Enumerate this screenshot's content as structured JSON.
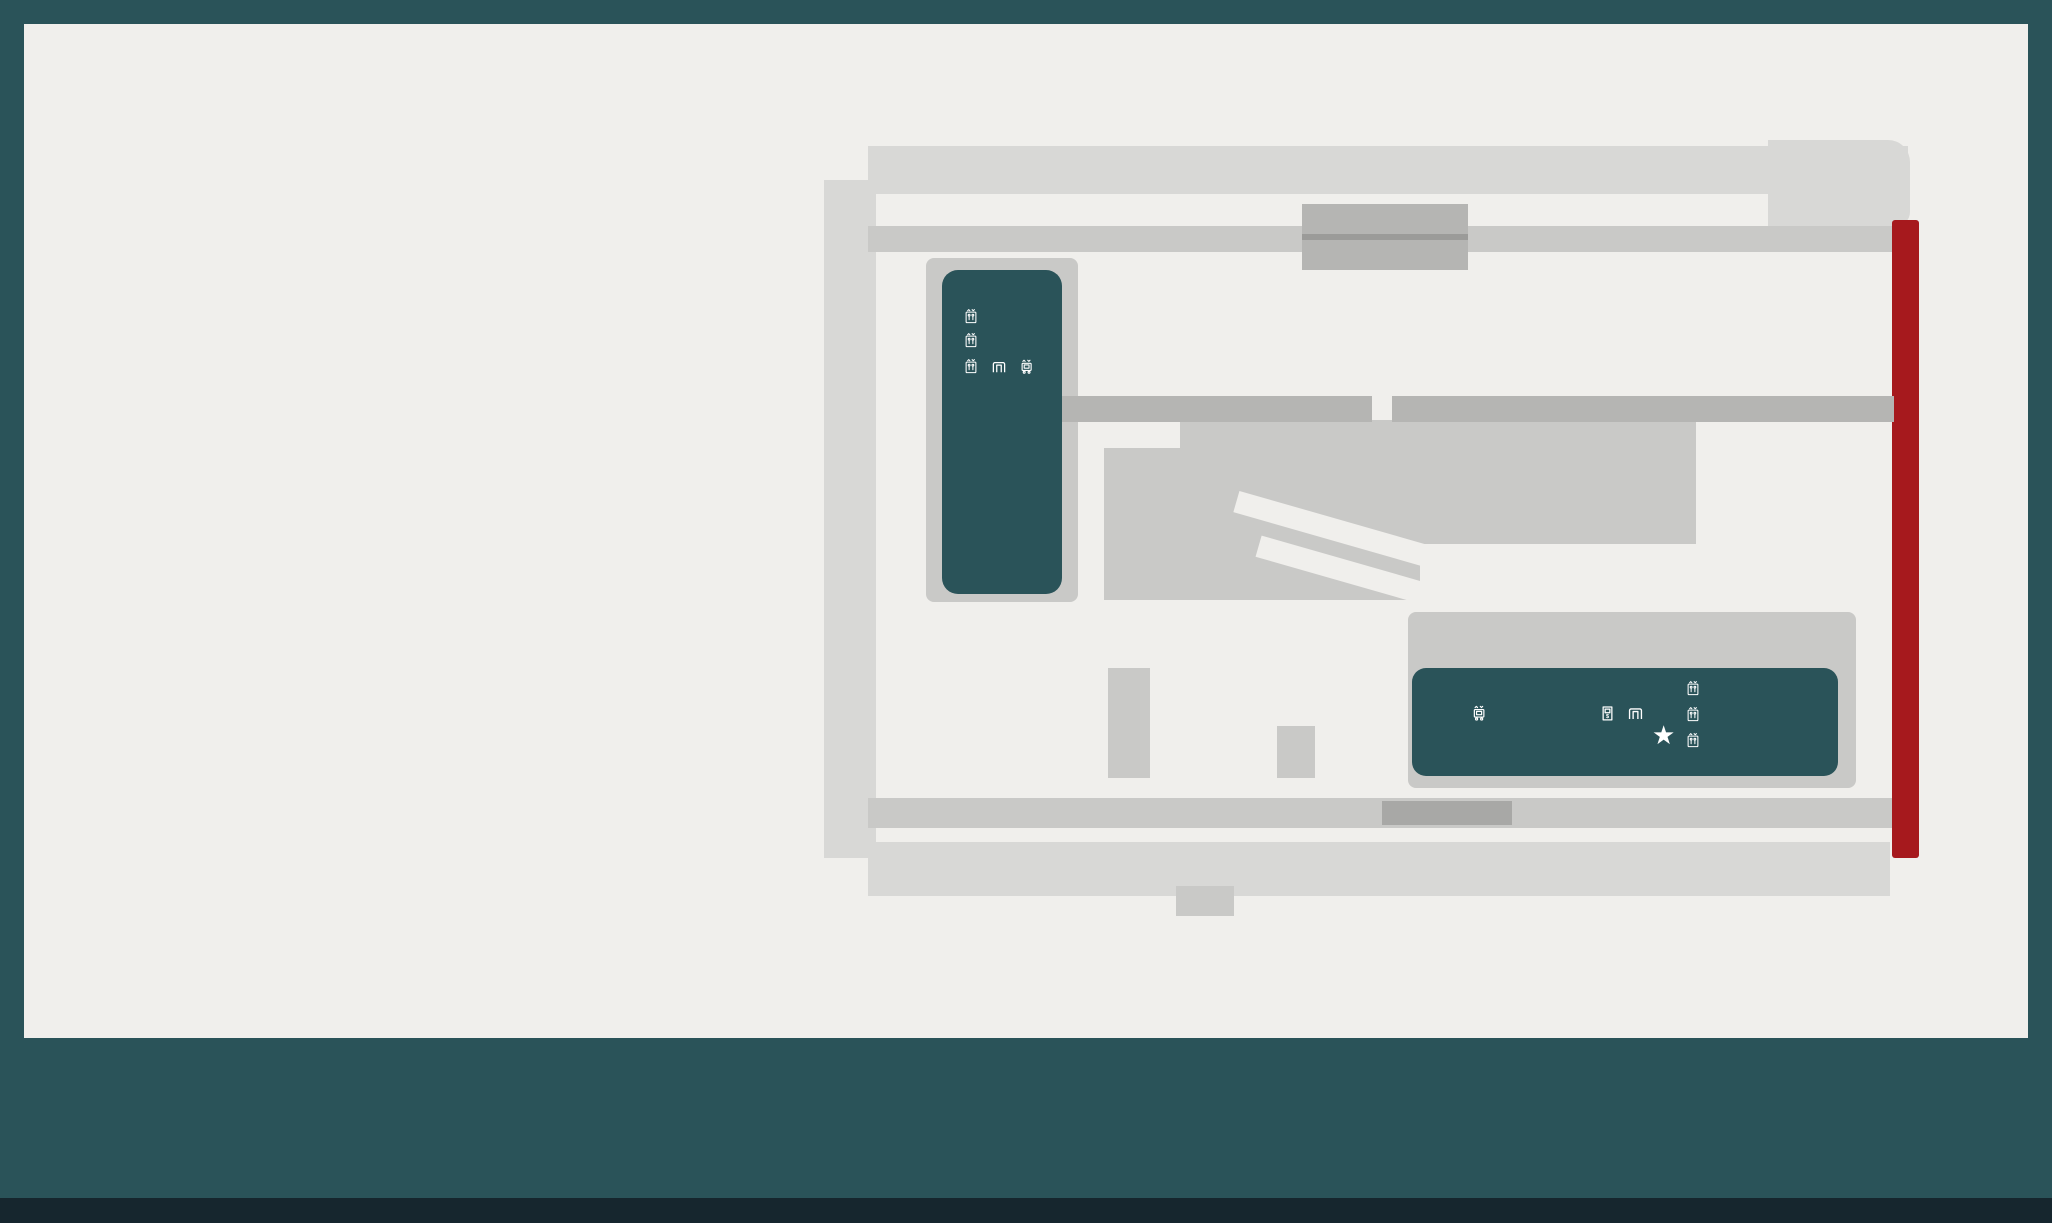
{
  "footer": {
    "level": "P4",
    "logo_letters": [
      "O",
      "X",
      "F",
      "O",
      "R",
      "D"
    ],
    "logo_bar_heights": [
      54,
      84,
      66,
      100,
      76
    ],
    "locations": [
      {
        "name": "Centennial Place East",
        "lines": [
          "520 3 Avenue South West,",
          "Calgary, Alberta T2P 0R3",
          "Lot 52"
        ],
        "x": 1428
      },
      {
        "name": "Centennial Place West",
        "lines": [
          "250 5th Street South West,",
          "Calgary, Alberta T2P 0R4",
          "Lot 52"
        ],
        "x": 1724
      }
    ]
  },
  "legend": {
    "left": [
      {
        "icon": "parking",
        "ring": "#223f46",
        "title": "Parking",
        "sub": ""
      },
      {
        "icon": "wheelchair",
        "ring": "#1b75bb",
        "title": "Barrier Free Parking",
        "sub": "Permit required"
      },
      {
        "icon": "carpool",
        "ring": "#7cab3c",
        "title": "Carpool Parking",
        "sub": "Permit required"
      },
      {
        "icon": "car",
        "ring": "#e2b322",
        "title": "Small Car Parking",
        "sub": ""
      },
      {
        "icon": "moto",
        "ring": "#b12025",
        "title": "Motorcycle Parking",
        "sub": "With or without a monthly parking pass"
      },
      {
        "icon": "battery",
        "ring": "#2b8a3d",
        "title": "Electric Vehicle Charging",
        "sub": ""
      },
      {
        "icon": "gate",
        "ring": "#e2b322",
        "title": "Entrance / Exit Gate",
        "sub": ""
      },
      {
        "icon": "wash",
        "ring": "#2c5f67",
        "title": "Window Wash",
        "sub": "Stations"
      },
      {
        "icon": "air",
        "ring": "#2c5f67",
        "title": "Air / Washer Fluid",
        "sub": "Stations"
      },
      {
        "icon": "recycle",
        "ring": "#2c5f67",
        "title": "Recycling",
        "sub": "Cans/bottles/cardboard and paper"
      },
      {
        "icon": "stairs",
        "ring": "#df8528",
        "title": "Stairwell Access",
        "sub": ""
      }
    ],
    "right": [
      {
        "icon": "lock",
        "ring": "split",
        "title": "Locker Rooms",
        "sub": ""
      },
      {
        "icon": "wc",
        "ring": "split",
        "title": "Washrooms",
        "sub": "Not for public use"
      },
      {
        "icon": "shower",
        "ring": "split",
        "title": "Showers",
        "sub": ""
      },
      {
        "icon": "carwash",
        "ring": "split",
        "title": "Car Wash",
        "sub": "Open to the public"
      },
      {
        "icon": "paystation",
        "ring": "#1f4f57",
        "title": "QR Pay Stations",
        "sub": "For public parking"
      },
      {
        "icon": "lobby",
        "ring": "#2c5f67",
        "title": "Elevator Lobby",
        "sub": ""
      },
      {
        "icon": "elevator",
        "ring": "#2c5f67",
        "title": "Elevator Access",
        "sub": "+15, Ground, P1 - P4"
      },
      {
        "icon": "freight",
        "ring": "#2c5f67",
        "title": "Freight Elevator",
        "sub": "P3 - Floor 24"
      },
      {
        "icon": "freight",
        "ring": "#2c5f67",
        "title": "Freight Elevator",
        "sub": "P3 - Floor 41"
      },
      {
        "icon": "clock",
        "ring": "#8248a8",
        "title": "Short stay parking",
        "sub": "4 hrs max (day care)."
      },
      {
        "icon": "star",
        "ring": "#2c5f67",
        "title": "You are here",
        "sub": ""
      }
    ]
  },
  "map": {
    "labels": {
      "avenue": "2ND AVENUE SW",
      "street_left": "5TH STREET SW",
      "street_right": "4TH STREET SW",
      "down_p5": "DOWN TO P5",
      "up_p3": "UP TO P3",
      "arr_r": "»»",
      "arr_l": "««",
      "traffic_arrow": "«",
      "traffic": "TRAFFIC FLOW",
      "entrance1": "PARKING ENTRANCE 5AM- 9AM",
      "entrance2": "REVERTS TO AN EXIT AT 9 AM, NO PUBLIC"
    },
    "blocks": {
      "west": "WEST",
      "east": "EAST"
    },
    "rows": [
      {
        "x": 877,
        "y": 156,
        "pitch": 28.6,
        "h": 34,
        "nums": [
          "688",
          "689",
          "690",
          "691",
          "692",
          "693",
          "694",
          "695",
          "696",
          "697",
          "698",
          "699",
          "700",
          "701",
          "493",
          "494",
          "495",
          "496",
          "497",
          "498",
          "499",
          "500",
          "501",
          "502",
          "503",
          "504",
          "505",
          "506",
          "507",
          "508",
          "509",
          "510"
        ]
      },
      {
        "x": 830,
        "y": 216,
        "pitch": 29.6,
        "w": 42,
        "vert": true,
        "nums": [
          "687",
          "686",
          "685",
          "684",
          "683",
          "682",
          "681",
          "680",
          "679",
          "678",
          "677",
          "676",
          "675",
          "674",
          "673",
          "672",
          "671",
          "670",
          "669",
          "668",
          "667"
        ]
      },
      {
        "x": 1062,
        "y": 291,
        "pitch": 29.3,
        "h": 43,
        "nums": [
          "721",
          "722",
          "723",
          "724",
          "725",
          "726",
          "727",
          "728",
          "521",
          "522",
          "523",
          "524",
          "525",
          "526",
          "527",
          "528",
          "529",
          "530",
          "531",
          "532",
          "533",
          "534",
          "535",
          "536",
          "537"
        ]
      },
      {
        "x": 1062,
        "y": 337,
        "pitch": 29.3,
        "h": 43,
        "nums": [
          "770",
          "769",
          "768",
          "767",
          "766",
          "765",
          "764",
          "763",
          "554",
          "553",
          "552",
          "551",
          "550",
          "549",
          "548",
          "547",
          "546",
          "545",
          "544",
          "543",
          "542",
          "541",
          "540",
          "539",
          "538"
        ]
      },
      {
        "x": 1185,
        "y": 428,
        "pitch": 23,
        "h": 38,
        "nums": [
          "774",
          "775",
          "776",
          "777",
          "570",
          "571",
          "572",
          "573",
          "574",
          "575",
          "576",
          "577",
          "578",
          "579",
          "580",
          "581",
          "582",
          "583",
          "584"
        ]
      },
      {
        "x": 1637,
        "y": 428,
        "pitch": 24.5,
        "h": 38,
        "nums": [
          "585",
          "586"
        ]
      },
      {
        "x": 1337,
        "y": 490,
        "pitch": 23.5,
        "h": 44,
        "nums": [
          "600",
          "599",
          "598",
          "597",
          "596",
          "595",
          "594",
          "593",
          "592",
          "591",
          "590",
          "589"
        ]
      },
      {
        "x": 1637,
        "y": 490,
        "pitch": 24.5,
        "h": 44,
        "nums": [
          "588",
          "587"
        ]
      },
      {
        "x": 945,
        "y": 668,
        "pitch": 26.3,
        "h": 52,
        "nums": [
          "604",
          "605",
          "606",
          "607",
          "608",
          "609"
        ]
      },
      {
        "x": 945,
        "y": 726,
        "pitch": 26.3,
        "h": 52,
        "nums": [
          "633",
          "632",
          "631",
          "630",
          "629",
          "628"
        ]
      },
      {
        "x": 1158,
        "y": 668,
        "pitch": 28.7,
        "h": 52,
        "nums": [
          "610",
          "611",
          "612",
          "613"
        ]
      },
      {
        "x": 1158,
        "y": 726,
        "pitch": 28.7,
        "h": 52,
        "nums": [
          "627",
          "626",
          "625",
          "624"
        ]
      },
      {
        "x": 1320,
        "y": 668,
        "pitch": 26,
        "h": 52,
        "nums": [
          "615",
          "616",
          "617"
        ]
      },
      {
        "x": 1320,
        "y": 726,
        "pitch": 26,
        "h": 52,
        "nums": [
          "623",
          "622",
          "621"
        ]
      },
      {
        "x": 877,
        "y": 852,
        "pitch": 29.4,
        "h": 34,
        "nums": [
          "666",
          "665",
          "664",
          "663",
          "662",
          "661",
          "660",
          "659",
          "658",
          "657",
          "656",
          "655",
          "654",
          "653",
          "652",
          "651",
          "650",
          "649",
          "648",
          "647",
          "646",
          "645",
          "644",
          "643",
          "642",
          "641",
          "640",
          "639",
          "638",
          "637",
          "636"
        ]
      }
    ],
    "stalls": [
      {
        "n": "687A",
        "x": 830,
        "y": 186,
        "w": 42,
        "h": 28,
        "c": "yellow",
        "r": 14
      },
      {
        "n": "",
        "x": 1778,
        "y": 150,
        "w": 26,
        "h": 42,
        "c": "yellow",
        "r": 4
      },
      {
        "n": "511",
        "x": 1808,
        "y": 152,
        "w": 34,
        "h": 40,
        "r": 8
      },
      {
        "n": "512",
        "x": 1846,
        "y": 162,
        "w": 36,
        "h": 48,
        "r": 10
      },
      {
        "n": "",
        "x": 1802,
        "y": 281,
        "w": 28,
        "h": 95,
        "c": "orange",
        "r": 4
      },
      {
        "n": "773",
        "x": 1122,
        "y": 462,
        "w": 54,
        "h": 40,
        "c": "blue",
        "r": 10
      },
      {
        "n": "772",
        "x": 1122,
        "y": 504,
        "w": 54,
        "h": 42,
        "c": "blue",
        "r": 10
      },
      {
        "n": "771",
        "x": 1122,
        "y": 552,
        "w": 54,
        "h": 36,
        "r": 10
      },
      {
        "n": "601",
        "x": 1288,
        "y": 490,
        "w": 58,
        "h": 44,
        "r": 10
      },
      {
        "n": "602",
        "x": 1220,
        "y": 516,
        "w": 30,
        "h": 62,
        "rot": -40,
        "r": 8
      },
      {
        "n": "603",
        "x": 1192,
        "y": 534,
        "w": 30,
        "h": 62,
        "rot": -40,
        "r": 8
      },
      {
        "n": "614",
        "x": 1277,
        "y": 668,
        "w": 38,
        "h": 52,
        "c": "blue",
        "r": 10
      },
      {
        "n": "618",
        "x": 1440,
        "y": 620,
        "w": 62,
        "h": 30,
        "r": 15
      },
      {
        "n": "619",
        "x": 1522,
        "y": 620,
        "w": 62,
        "h": 30,
        "r": 15
      },
      {
        "n": "620",
        "x": 1700,
        "y": 620,
        "w": 62,
        "h": 30,
        "r": 15
      },
      {
        "n": "635",
        "x": 1792,
        "y": 848,
        "w": 38,
        "h": 44,
        "c": "blue",
        "r": 10
      },
      {
        "n": "634",
        "x": 1836,
        "y": 848,
        "w": 38,
        "h": 44,
        "r": 10
      }
    ],
    "pins": [
      {
        "i": "car",
        "x": 852,
        "y": 150,
        "d": "down"
      },
      {
        "i": "p",
        "x": 1337,
        "y": 116,
        "d": "down"
      },
      {
        "i": "carwash",
        "x": 1791,
        "y": 108,
        "d": "down"
      },
      {
        "i": "p",
        "x": 1827,
        "y": 112,
        "d": "down"
      },
      {
        "i": "p",
        "x": 1928,
        "y": 185,
        "d": "left"
      },
      {
        "i": "p",
        "x": 1500,
        "y": 248,
        "d": "down"
      },
      {
        "i": "recycle",
        "x": 929,
        "y": 408,
        "d": "down"
      },
      {
        "i": "wash",
        "x": 926,
        "y": 460,
        "d": "down"
      },
      {
        "i": "wash",
        "x": 1070,
        "y": 430,
        "d": "down"
      },
      {
        "i": "recycle",
        "x": 1070,
        "y": 476,
        "d": "down"
      },
      {
        "i": "wheelchair",
        "x": 1145,
        "y": 446,
        "d": "down"
      },
      {
        "i": "p",
        "x": 1222,
        "y": 488,
        "d": "up"
      },
      {
        "i": "p",
        "x": 1300,
        "y": 458,
        "d": "down"
      },
      {
        "i": "p",
        "x": 1475,
        "y": 468,
        "d": "down"
      },
      {
        "i": "p",
        "x": 1662,
        "y": 458,
        "d": "down"
      },
      {
        "i": "carwash",
        "x": 1816,
        "y": 395,
        "d": "up"
      },
      {
        "i": "moto",
        "x": 1930,
        "y": 546,
        "d": "down"
      },
      {
        "i": "p",
        "x": 806,
        "y": 584,
        "d": "right"
      },
      {
        "i": "air",
        "x": 1130,
        "y": 695,
        "d": "down"
      },
      {
        "i": "p",
        "x": 1023,
        "y": 638,
        "d": "down"
      },
      {
        "i": "p",
        "x": 1217,
        "y": 638,
        "d": "down"
      },
      {
        "i": "wheelchair",
        "x": 1296,
        "y": 636,
        "d": "down"
      },
      {
        "i": "p",
        "x": 1361,
        "y": 638,
        "d": "down"
      },
      {
        "i": "p",
        "x": 1479,
        "y": 592,
        "d": "down"
      },
      {
        "i": "p",
        "x": 1552,
        "y": 590,
        "d": "down"
      },
      {
        "i": "p",
        "x": 1740,
        "y": 590,
        "d": "down"
      },
      {
        "i": "recycle",
        "x": 1633,
        "y": 632,
        "d": "down"
      },
      {
        "i": "wash",
        "x": 1671,
        "y": 632,
        "d": "down"
      },
      {
        "i": "recycle",
        "x": 1591,
        "y": 756,
        "d": "down"
      },
      {
        "i": "wash",
        "x": 1629,
        "y": 756,
        "d": "down"
      },
      {
        "i": "p",
        "x": 1021,
        "y": 798,
        "d": "up"
      },
      {
        "i": "p",
        "x": 1211,
        "y": 798,
        "d": "up"
      },
      {
        "i": "p",
        "x": 1361,
        "y": 798,
        "d": "up"
      },
      {
        "i": "p",
        "x": 1082,
        "y": 820,
        "d": "down"
      },
      {
        "i": "wheelchair",
        "x": 1806,
        "y": 820,
        "d": "down"
      },
      {
        "i": "p",
        "x": 1855,
        "y": 820,
        "d": "down"
      }
    ],
    "chevrons": [
      {
        "t": "«",
        "x": 1605,
        "y": 226,
        "c": "#ffffff"
      },
      {
        "t": "»",
        "x": 1692,
        "y": 226,
        "c": "#ffffff"
      },
      {
        "t": "«",
        "x": 1030,
        "y": 604,
        "c": "#9b9b99"
      },
      {
        "t": "»",
        "x": 1120,
        "y": 604,
        "c": "#9b9b99"
      },
      {
        "t": "«",
        "x": 1534,
        "y": 540,
        "c": "#9b9b99"
      },
      {
        "t": "«",
        "x": 1620,
        "y": 540,
        "c": "#9b9b99"
      }
    ]
  }
}
